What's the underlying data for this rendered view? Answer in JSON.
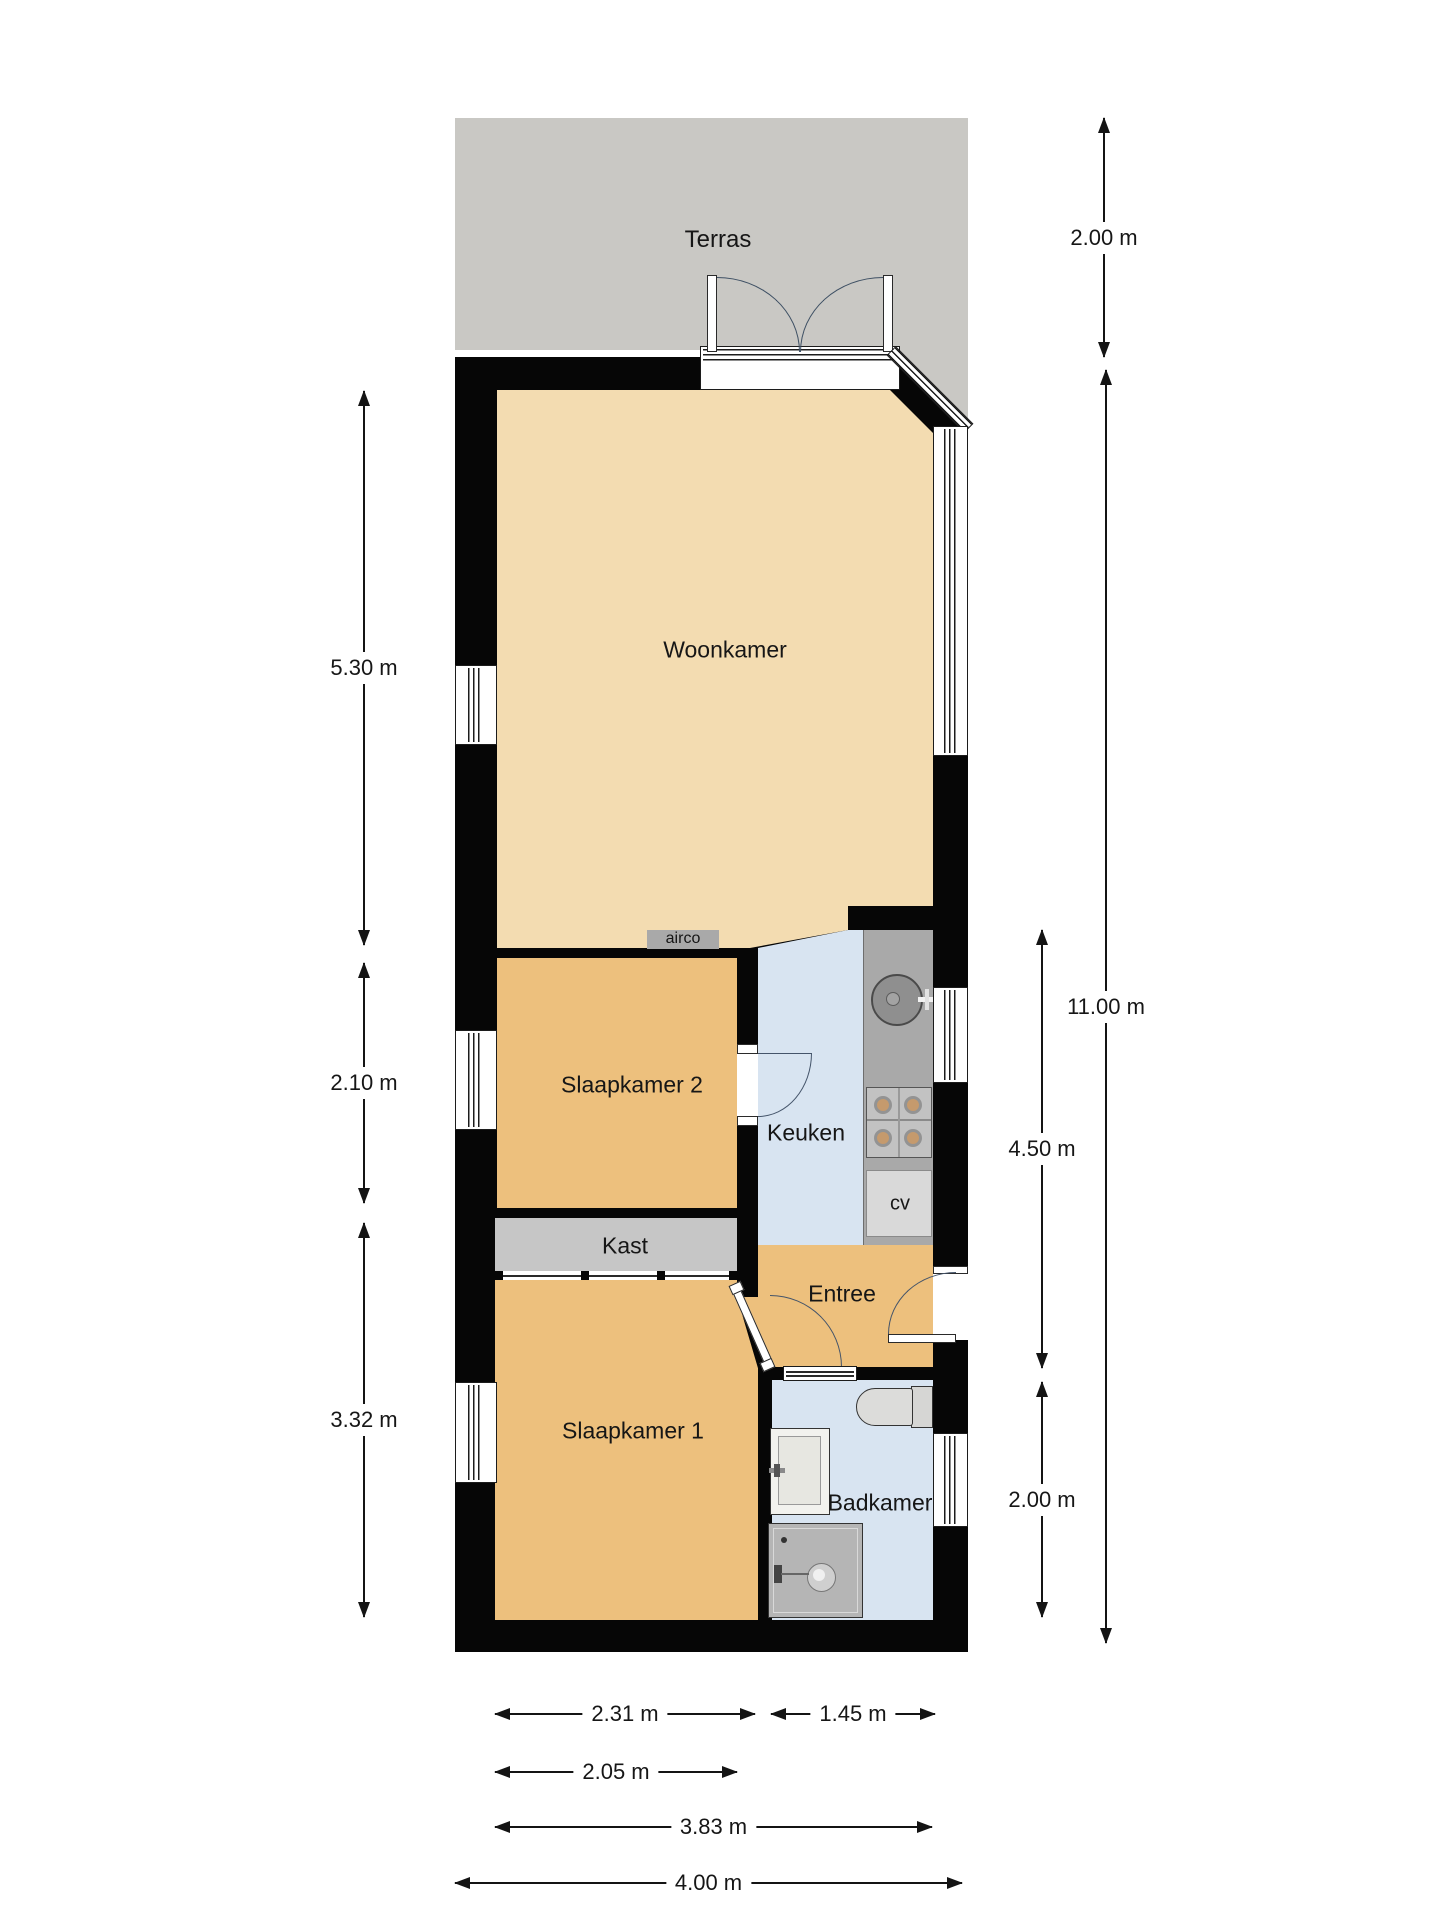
{
  "plan": {
    "type": "floorplan",
    "colors": {
      "wall": "#060606",
      "terrace": "#c9c8c4",
      "living_floor": "#f3dcb1",
      "bedroom_floor": "#edc07d",
      "wet_room_floor": "#d8e4f1",
      "closet": "#c6c6c6",
      "appliance_gray": "#a9a9a9",
      "door_arc": "#3d4f63",
      "dimension_text": "#141414"
    },
    "rooms": {
      "terras": {
        "label": "Terras"
      },
      "woonkamer": {
        "label": "Woonkamer"
      },
      "slaapkamer2": {
        "label": "Slaapkamer 2"
      },
      "keuken": {
        "label": "Keuken"
      },
      "kast": {
        "label": "Kast"
      },
      "entree": {
        "label": "Entree"
      },
      "slaapkamer1": {
        "label": "Slaapkamer 1"
      },
      "badkamer": {
        "label": "Badkamer"
      },
      "airco": {
        "label": "airco"
      },
      "cv": {
        "label": "cv"
      }
    },
    "dimensions": {
      "left": [
        {
          "label": "5.30 m"
        },
        {
          "label": "2.10 m"
        },
        {
          "label": "3.32 m"
        }
      ],
      "right": [
        {
          "label": "2.00 m"
        },
        {
          "label": "11.00 m"
        },
        {
          "label": "4.50 m"
        },
        {
          "label": "2.00 m"
        }
      ],
      "bottom": [
        {
          "label": "2.31 m"
        },
        {
          "label": "1.45 m"
        },
        {
          "label": "2.05 m"
        },
        {
          "label": "3.83 m"
        },
        {
          "label": "4.00 m"
        }
      ]
    }
  }
}
